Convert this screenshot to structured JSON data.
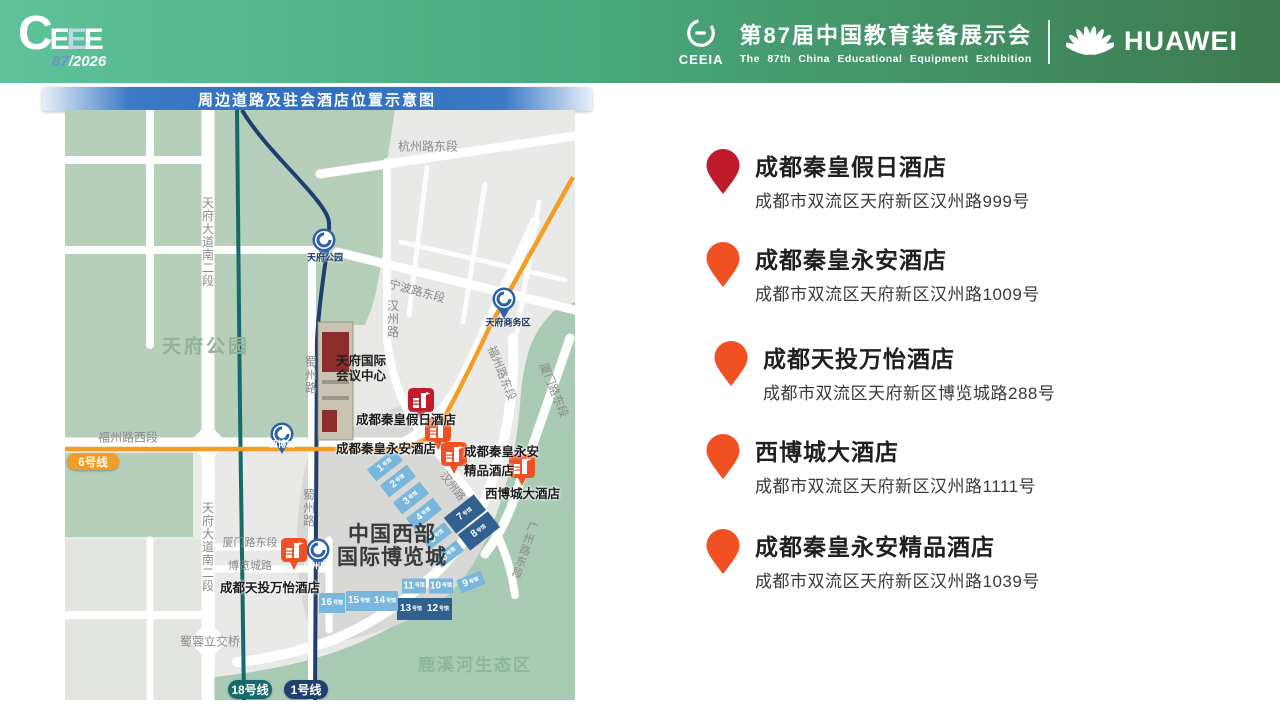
{
  "colors": {
    "pinred": "#bf1b2c",
    "pinorange": "#f15023",
    "metroblue": "#2d62a8",
    "line1": "#1f3f6e",
    "line18": "#176a6b",
    "line6": "#f49d26",
    "halllight": "#79b7dc",
    "halldark": "#2f608f",
    "park": "#b6cfba",
    "eco": "#a9cab5",
    "roadlabel": "#8b8b8b",
    "headerl": "#5ec29a",
    "headerr": "#3c7b4e",
    "banner": "#2f6fbe"
  },
  "header": {
    "logo": {
      "c": "C",
      "e1": "E",
      "e2": "E",
      "e3": "E",
      "num": "87",
      "year": "/2026"
    },
    "ceeia": "CEEIA",
    "title_cn": "第87届中国教育装备展示会",
    "title_en": "The 87th China Educational Equipment Exhibition",
    "huawei": "HUAWEI"
  },
  "map": {
    "banner_title": "周边道路及驻会酒店位置示意图",
    "area": {
      "park": "天府公园",
      "eco": "鹿溪河生态区"
    },
    "venue": {
      "l1": "中国西部",
      "l2": "国际博览城"
    },
    "conf": {
      "l1": "天府国际",
      "l2": "会议中心"
    },
    "roads": [
      "杭州路东段",
      "天府大道南二段",
      "宁波路东段",
      "汉州路",
      "福州路东段",
      "厦门路东段",
      "福州路西段",
      "蜀州路",
      "蜀州路",
      "汉州路",
      "厦门路东段",
      "博览城路",
      "天府大道南二段",
      "蜀蓉立交桥",
      "广州路东段"
    ],
    "stations": [
      {
        "name": "天府公园"
      },
      {
        "name": "天府商务区"
      },
      {
        "name": "西博城"
      },
      {
        "name": "广州路"
      }
    ],
    "badges": [
      {
        "label": "6号线"
      },
      {
        "label": "18号线"
      },
      {
        "label": "1号线"
      }
    ],
    "hall_suffix": "号馆",
    "halls": [
      "1",
      "2",
      "3",
      "4",
      "5",
      "6",
      "7",
      "8",
      "9",
      "10",
      "11",
      "12",
      "13",
      "14",
      "15",
      "16"
    ],
    "hotel_labels": {
      "jiari": "成都秦皇假日酒店",
      "yongan": "成都秦皇永安酒店",
      "jingpin_l1": "成都秦皇永安",
      "jingpin_l2": "精品酒店",
      "xibocheng": "西博城大酒店",
      "wanyi": "成都天投万怡酒店"
    }
  },
  "hotel_list": [
    {
      "name": "成都秦皇假日酒店",
      "address": "成都市双流区天府新区汉州路999号"
    },
    {
      "name": "成都秦皇永安酒店",
      "address": "成都市双流区天府新区汉州路1009号"
    },
    {
      "name": "成都天投万怡酒店",
      "address": "成都市双流区天府新区博览城路288号"
    },
    {
      "name": "西博城大酒店",
      "address": "成都市双流区天府新区汉州路1111号"
    },
    {
      "name": "成都秦皇永安精品酒店",
      "address": "成都市双流区天府新区汉州路1039号"
    }
  ]
}
